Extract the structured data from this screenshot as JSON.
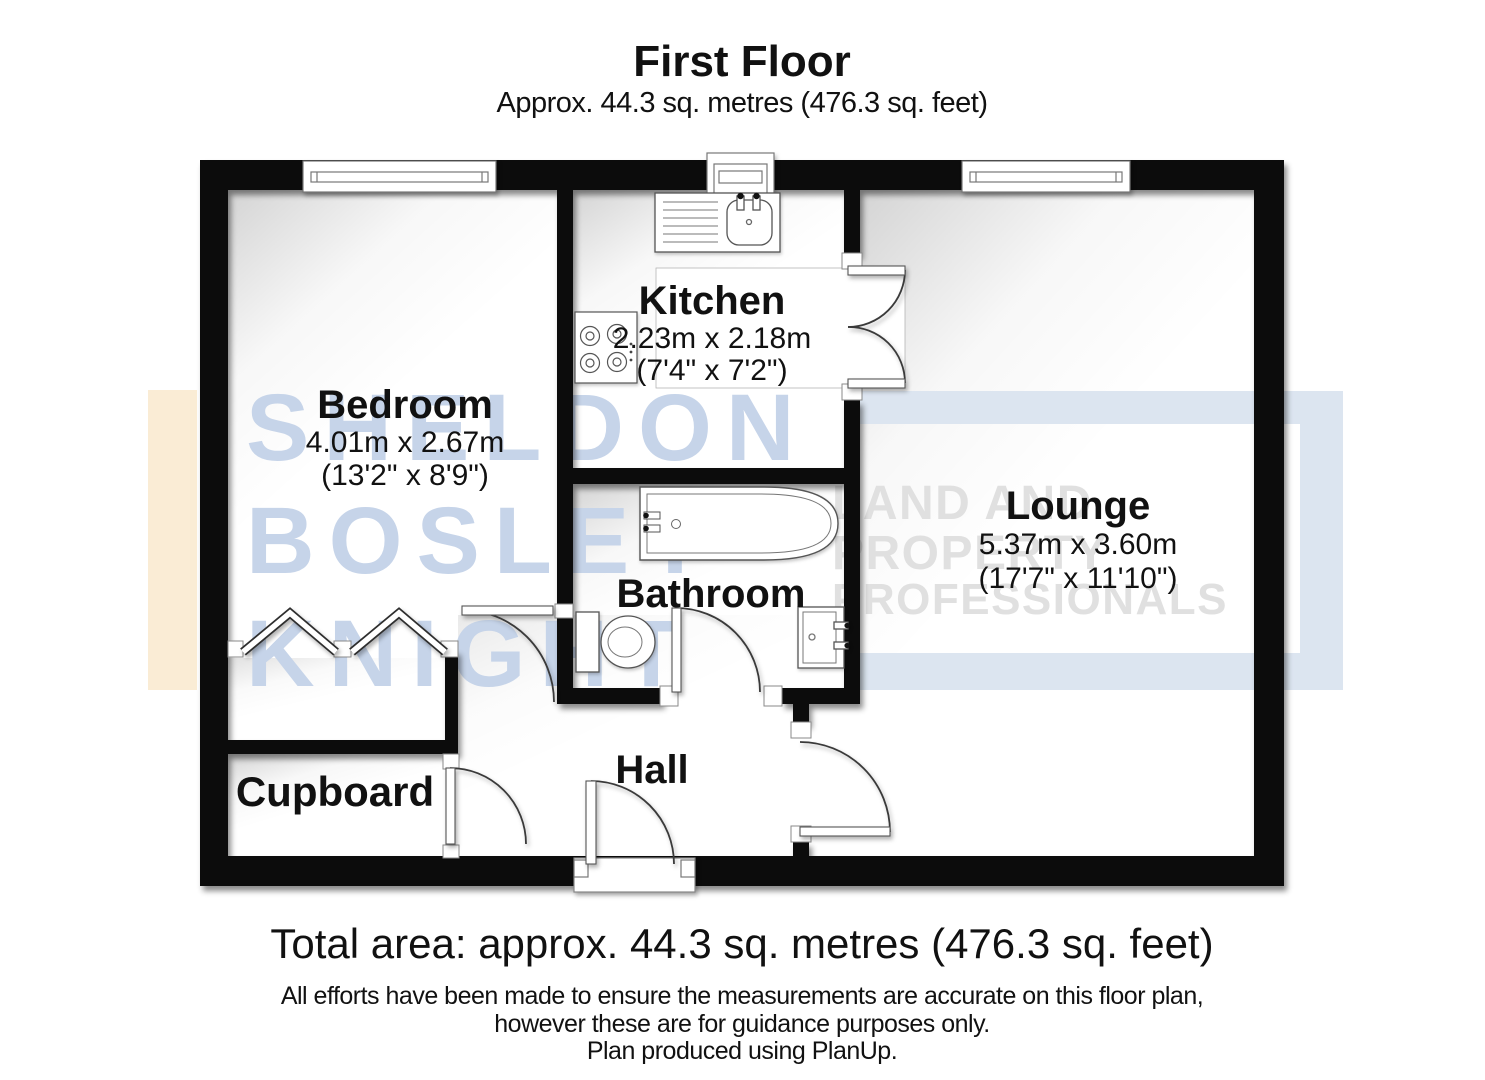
{
  "header": {
    "title": "First Floor",
    "subtitle": "Approx. 44.3 sq. metres (476.3 sq. feet)"
  },
  "rooms": {
    "bedroom": {
      "name": "Bedroom",
      "metric": "4.01m x 2.67m",
      "imperial": "(13'2\" x 8'9\")"
    },
    "kitchen": {
      "name": "Kitchen",
      "metric": "2.23m x 2.18m",
      "imperial": "(7'4\" x 7'2\")"
    },
    "lounge": {
      "name": "Lounge",
      "metric": "5.37m x 3.60m",
      "imperial": "(17'7\" x 11'10\")"
    },
    "bathroom": {
      "name": "Bathroom"
    },
    "hall": {
      "name": "Hall"
    },
    "cupboard": {
      "name": "Cupboard"
    }
  },
  "watermark": {
    "left_lines": [
      "SHELDON",
      "BOSLEY",
      "KNIGHT"
    ],
    "right_lines": [
      "LAND AND",
      "PROPERTY",
      "PROFESSIONALS"
    ],
    "colors": {
      "blue_text": "#c6d4e9",
      "gray_text": "#e0e0e0",
      "cream_bar": "#faecd5",
      "blue_frame": "#dce5f0"
    }
  },
  "footer": {
    "total_area": "Total area: approx. 44.3 sq. metres (476.3 sq. feet)",
    "disclaimer1": "All efforts have been made to ensure the measurements are accurate on this floor plan,",
    "disclaimer2": "however these are for guidance purposes only.",
    "credit": "Plan produced using PlanUp."
  }
}
